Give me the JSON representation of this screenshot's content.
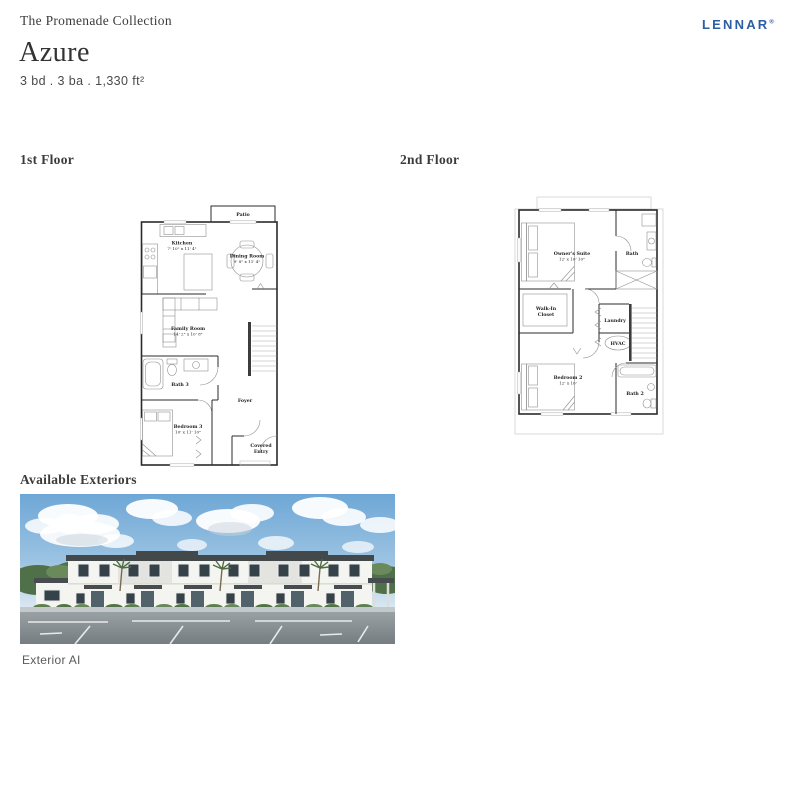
{
  "header": {
    "collection": "The Promenade Collection",
    "plan_name": "Azure",
    "specs": "3 bd . 3 ba . 1,330 ft²",
    "brand": "LENNAR",
    "brand_registered": "®",
    "brand_color": "#2c5ea6"
  },
  "floors": {
    "first": {
      "title": "1st Floor",
      "rooms": {
        "patio": "Patio",
        "kitchen": "Kitchen",
        "kitchen_dims": "7' 10\" x 11' 4\"",
        "dining": "Dining Room",
        "dining_dims": "9' 8\" x 11' 4\"",
        "family": "Family Room",
        "family_dims": "14' 2\" x 10' 8\"",
        "bath3": "Bath 3",
        "foyer": "Foyer",
        "bedroom3": "Bedroom 3",
        "bedroom3_dims": "10' x 11' 10\"",
        "covered_entry_line1": "Covered",
        "covered_entry_line2": "Entry"
      }
    },
    "second": {
      "title": "2nd Floor",
      "rooms": {
        "owners_suite": "Owner's Suite",
        "owners_suite_dims": "12' x 10' 10\"",
        "bath": "Bath",
        "walk_in_closet_line1": "Walk-In",
        "walk_in_closet_line2": "Closet",
        "laundry": "Laundry",
        "hvac": "HVAC",
        "bedroom2": "Bedroom 2",
        "bedroom2_dims": "12' x 10'",
        "bath2": "Bath 2"
      }
    }
  },
  "exteriors": {
    "title": "Available Exteriors",
    "caption": "Exterior AI",
    "photo_palette": {
      "sky": "#6ea7d6",
      "cloud": "#ffffff",
      "trees": "#4f7048",
      "walls": "#f4f4f1",
      "roof": "#43484b",
      "door": "#51626a",
      "asphalt": "#9aa1a4"
    }
  }
}
